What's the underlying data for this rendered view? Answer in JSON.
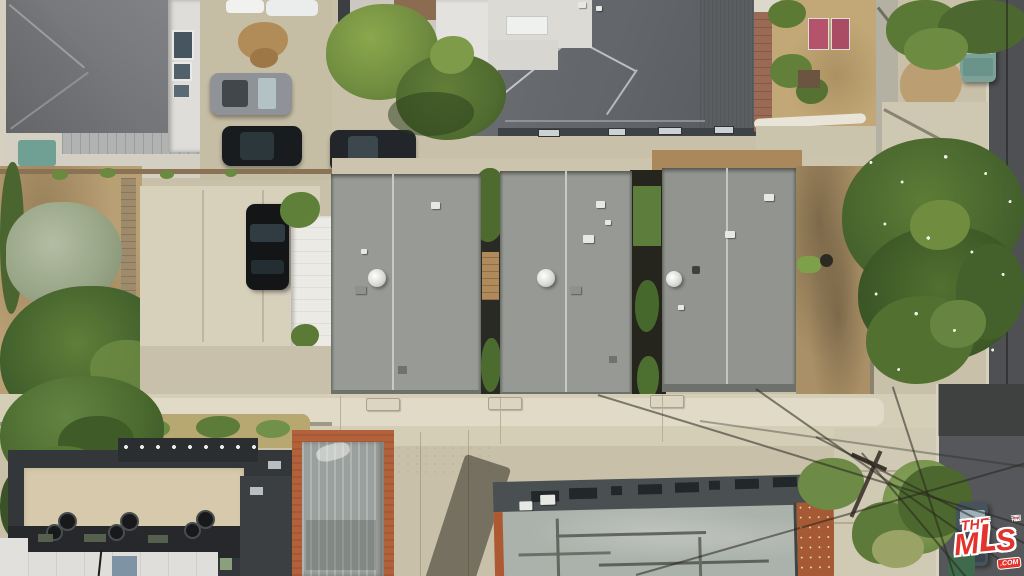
{
  "title": "Aerial property photograph",
  "watermark": {
    "brand_the": "THE",
    "letters": [
      "M",
      "L",
      "S"
    ],
    "brand_tm": "™",
    "brand_com": ".COM",
    "brand_color": "#E2342C",
    "brand_outline": "#FFFFFF"
  },
  "scene": {
    "type": "top-down aerial drone photo",
    "setting": "residential block with rear alley and street parking",
    "subject": "row of three gray shingle-roofed units between neighboring buildings",
    "counts": {
      "gray_shingle_roofs": 3,
      "satellite_dishes": 3,
      "street_parked_cars": 5,
      "driveway_parked_cars": 1
    },
    "vehicles": [
      "white car",
      "white car",
      "silver SUV",
      "black sedan",
      "dark gray sedan",
      "black car on parking pad",
      "teal car top right",
      "dark car bottom right street"
    ],
    "vegetation": [
      "street trees",
      "silver olive tree",
      "hedges",
      "flowering magnolia tree",
      "shrubs",
      "weeds along driveway"
    ],
    "ground": [
      "concrete alley",
      "dirt yards",
      "gravel parking pad",
      "sidewalk",
      "asphalt street"
    ],
    "structures": [
      "gable-roof house top left",
      "large dark hip-roof building top center",
      "charcoal flat-roof building bottom left",
      "terracotta-trimmed roof bottom center",
      "weathered warehouse roof bottom center",
      "chain-link fence",
      "utility pole with power lines",
      "pink gate"
    ],
    "palette": {
      "concrete": "#CFC7B1",
      "roof_gray": "#94978F",
      "dark_roof": "#63666A",
      "charcoal_building": "#33373A",
      "tan_roof": "#D7CAAC",
      "terracotta_trim": "#B2613A",
      "asphalt": "#55575A",
      "foliage_dark": "#3C5626",
      "foliage_light": "#6D8C42",
      "dirt": "#B99F74",
      "teal_tarp": "#6FA093"
    }
  }
}
